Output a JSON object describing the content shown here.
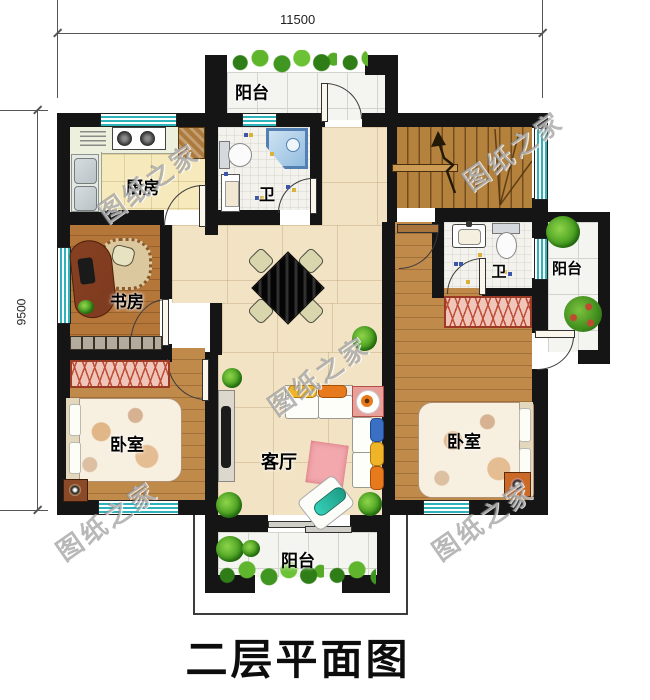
{
  "title": "二层平面图",
  "watermark": "图纸之家",
  "dimensions": {
    "top": "11500",
    "left": "9500"
  },
  "rooms": {
    "balcony_top": "阳台",
    "kitchen": "厨房",
    "bath_top": "卫",
    "study": "书房",
    "bedroom_left": "卧室",
    "living": "客厅",
    "bedroom_right": "卧室",
    "bath_right": "卫",
    "balcony_right": "阳台",
    "balcony_bottom": "阳台"
  },
  "colors": {
    "wall": "#151515",
    "window_teal": "#2fb3ba",
    "floor_cream": "#f2e3c4",
    "floor_wood": "#c08a4a",
    "wardrobe_pink": "#f0c5ba",
    "plant_green": "#4ba122",
    "stairs_wood": "#b5823e"
  }
}
